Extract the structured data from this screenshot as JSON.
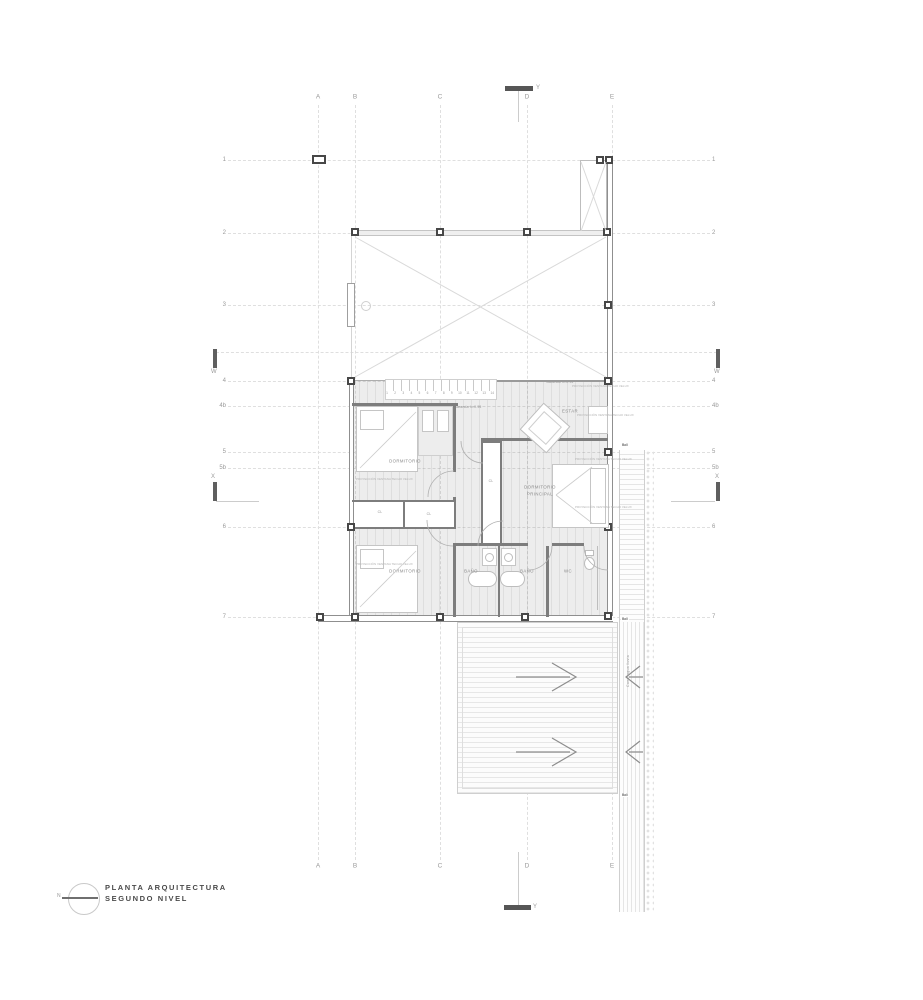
{
  "title_block": {
    "north_label": "N",
    "line1": "PLANTA ARQUITECTURA",
    "line2": "SEGUNDO NIVEL"
  },
  "grid": {
    "columns": [
      "A",
      "B",
      "C",
      "D",
      "E"
    ],
    "rows": [
      "1",
      "2",
      "3",
      "4",
      "4b",
      "5",
      "5b",
      "6",
      "7"
    ],
    "marker_w": "W",
    "marker_x": "X",
    "marker_y": "Y"
  },
  "rooms": {
    "dormitorio": "DORMITORIO",
    "dormitorio_principal_1": "DORMITORIO",
    "dormitorio_principal_2": "PRINCIPAL",
    "estar": "ESTAR",
    "bano": "BAÑO",
    "wc": "WC",
    "closet": "CL"
  },
  "stairs": {
    "numbers": [
      "1",
      "2",
      "3",
      "4",
      "5",
      "6",
      "7",
      "8",
      "9",
      "10",
      "11",
      "12",
      "13",
      "14"
    ],
    "baranda_label": "Baranda h=0.95"
  },
  "annotations": {
    "proyeccion": "PROYECCIÓN VENTANA TECHO VELUX",
    "canal": "Canal agua lluvia",
    "downspout": "Ball"
  },
  "colors": {
    "floor_tint": "#e9e9e9",
    "wall": "#7d7d7d",
    "grid_line": "#dedede",
    "marker": "#5f5f5f",
    "label": "#8a8a8a"
  }
}
